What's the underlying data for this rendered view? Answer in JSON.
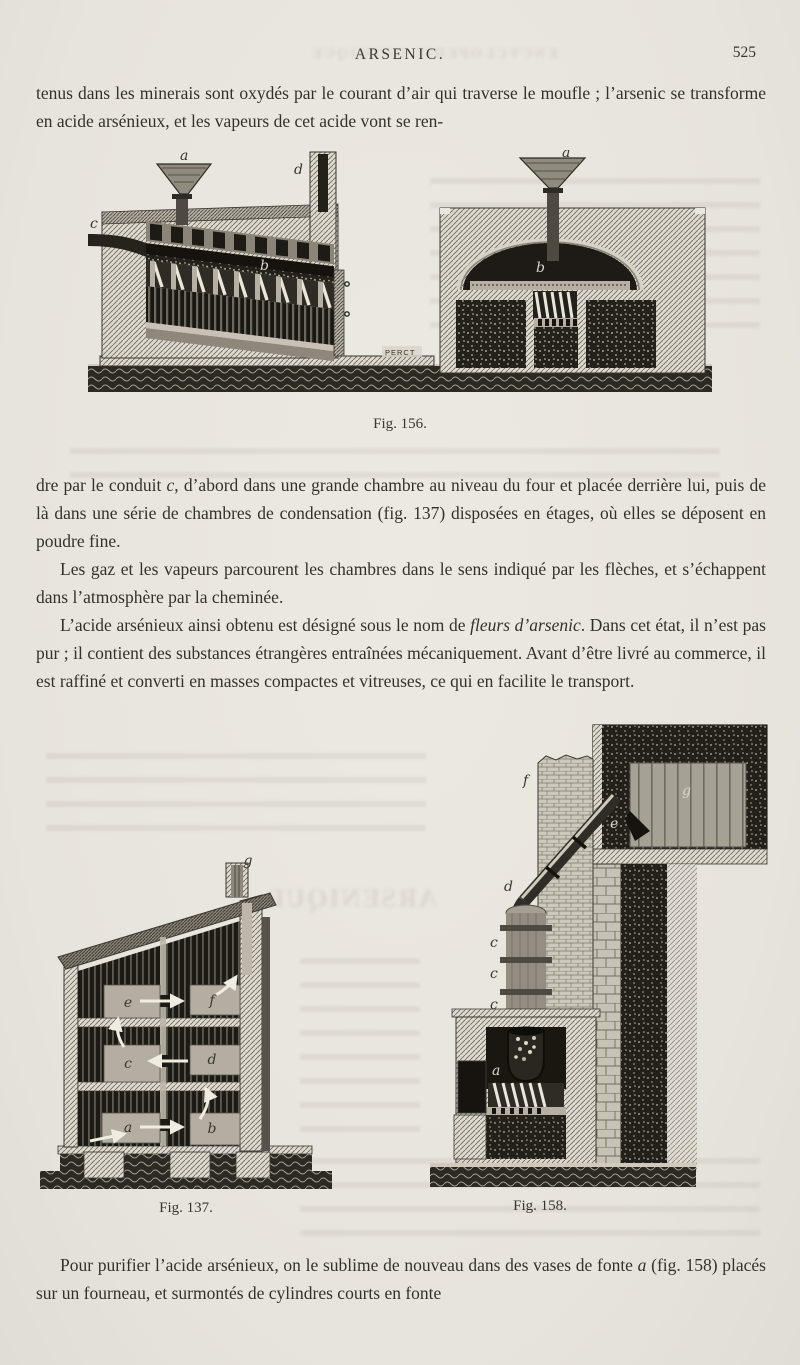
{
  "header": {
    "title": "ARSENIC.",
    "page_number": "525"
  },
  "paragraphs": {
    "p1": [
      {
        "t": "tenus dans les minerais sont oxydés par le courant d’air qui traverse le moufle ; l’arsenic se transforme en acide arsénieux, et les vapeurs de cet acide vont se ren-"
      }
    ],
    "p2": [
      {
        "t": "dre par le conduit "
      },
      {
        "t": "c",
        "i": true
      },
      {
        "t": ", d’abord dans une grande chambre au niveau du four et placée derrière lui, puis de là dans une série de chambres de condensation (fig. 137) disposées en étages, où elles se déposent en poudre fine."
      }
    ],
    "p3": [
      {
        "t": "Les gaz et les vapeurs parcourent les chambres dans le sens indiqué par les flèches, et s’échappent dans l’atmosphère par la cheminée."
      }
    ],
    "p4": [
      {
        "t": "L’acide arsénieux ainsi obtenu est désigné sous le nom de "
      },
      {
        "t": "fleurs d’arsenic",
        "i": true
      },
      {
        "t": ". Dans cet état, il n’est pas pur ; il contient des substances étrangères entraînées mécaniquement. Avant d’être livré au commerce, il est raffiné et converti en masses compactes et vitreuses, ce qui en facilite le transport."
      }
    ],
    "p5": [
      {
        "t": "Pour purifier l’acide arsénieux, on le sublime de nouveau dans des vases de fonte "
      },
      {
        "t": "a",
        "i": true
      },
      {
        "t": " (fig. 158) placés sur un fourneau, et surmontés de cylindres courts en fonte"
      }
    ]
  },
  "figures": {
    "fig156": {
      "caption": "Fig. 156.",
      "labels": {
        "funnel_left": "a",
        "chimney": "d",
        "conduit": "c",
        "muffle": "b",
        "funnel_right": "a",
        "dome": "b"
      },
      "signature": "PERCT"
    },
    "fig137": {
      "caption": "Fig. 137.",
      "labels": {
        "chamber_a": "a",
        "chamber_b": "b",
        "chamber_c": "c",
        "chamber_d": "d",
        "chamber_e": "e",
        "chamber_f": "f",
        "chimney": "g"
      }
    },
    "fig158": {
      "caption": "Fig. 158.",
      "labels": {
        "vase": "a",
        "cylinder": "b",
        "ring1": "c",
        "ring2": "c",
        "ring3": "c",
        "pipe": "d",
        "wall_pass": "e",
        "chimney": "f",
        "chamber": "g"
      }
    }
  },
  "colors": {
    "paper": "#e9e6df",
    "ink": "#33302a",
    "engraving": "#3a372f"
  }
}
